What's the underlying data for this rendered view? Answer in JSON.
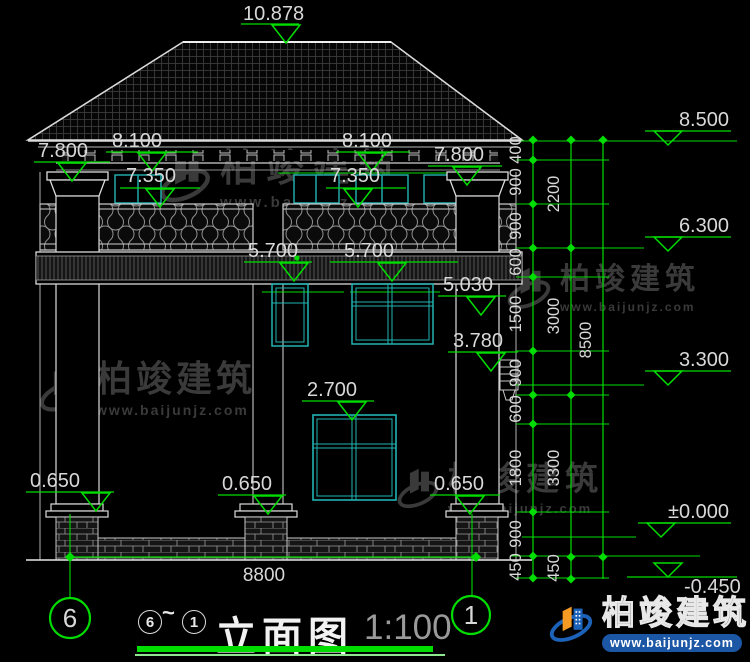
{
  "title_block": {
    "axis_left": "6",
    "axis_right": "1",
    "seq_start": "6",
    "seq_sep": "~",
    "seq_end": "1",
    "title": "立面图",
    "scale": "1:100"
  },
  "brand": {
    "name": "柏竣建筑",
    "url": "www.baijunjz.com"
  },
  "watermark": {
    "name": "柏竣建筑",
    "url": "www.baijunjz.com"
  },
  "colors": {
    "green": "#00dd00",
    "cyan": "#22b3b3",
    "dim_text": "#d8d8d8",
    "watermark": "#3a3a3a",
    "brand_blue": "#1b62b8",
    "brand_orange": "#f59a23"
  },
  "drawing": {
    "left_markers": [
      {
        "label": "10.878",
        "x1": 241,
        "x2": 299,
        "y": 24,
        "ax": 286,
        "tx": 243,
        "ty": 4
      },
      {
        "label": "8.100",
        "x1": 106,
        "x2": 198,
        "y": 152,
        "ax": 152,
        "tx": 112,
        "ty": 131
      },
      {
        "label": "8.100",
        "x1": 336,
        "x2": 410,
        "y": 152,
        "ax": 372,
        "tx": 342,
        "ty": 131
      },
      {
        "label": "7.800",
        "x1": 34,
        "x2": 110,
        "y": 162,
        "ax": 72,
        "tx": 38,
        "ty": 141
      },
      {
        "label": "7.800",
        "x1": 428,
        "x2": 502,
        "y": 166,
        "ax": 467,
        "tx": 434,
        "ty": 145
      },
      {
        "label": "7.350",
        "x1": 120,
        "x2": 200,
        "y": 188,
        "ax": 160,
        "tx": 126,
        "ty": 166
      },
      {
        "label": "7.350",
        "x1": 326,
        "x2": 406,
        "y": 188,
        "ax": 358,
        "tx": 330,
        "ty": 166
      },
      {
        "label": "5.700",
        "x1": 244,
        "x2": 312,
        "y": 262,
        "ax": 294,
        "tx": 248,
        "ty": 241
      },
      {
        "label": "5.700",
        "x1": 330,
        "x2": 458,
        "y": 262,
        "ax": 392,
        "tx": 344,
        "ty": 241
      },
      {
        "label": "5.030",
        "x1": 438,
        "x2": 506,
        "y": 296,
        "ax": 481,
        "tx": 443,
        "ty": 275
      },
      {
        "label": "3.780",
        "x1": 448,
        "x2": 518,
        "y": 352,
        "ax": 491,
        "tx": 453,
        "ty": 331
      },
      {
        "label": "2.700",
        "x1": 302,
        "x2": 374,
        "y": 401,
        "ax": 352,
        "tx": 307,
        "ty": 380
      },
      {
        "label": "0.650",
        "x1": 26,
        "x2": 114,
        "y": 492,
        "ax": 96,
        "tx": 30,
        "ty": 471
      },
      {
        "label": "0.650",
        "x1": 218,
        "x2": 286,
        "y": 495,
        "ax": 268,
        "tx": 222,
        "ty": 474
      },
      {
        "label": "0.650",
        "x1": 430,
        "x2": 500,
        "y": 495,
        "ax": 470,
        "tx": 434,
        "ty": 474
      }
    ],
    "right_levels": [
      {
        "label": "8.500",
        "y": 131,
        "x1": 645,
        "x2": 731,
        "ax": 668,
        "below": false
      },
      {
        "label": "6.300",
        "y": 237,
        "x1": 645,
        "x2": 731,
        "ax": 668,
        "below": false
      },
      {
        "label": "3.300",
        "y": 371,
        "x1": 645,
        "x2": 731,
        "ax": 668,
        "below": false
      },
      {
        "label": "±0.000",
        "y": 523,
        "x1": 638,
        "x2": 731,
        "ax": 661,
        "below": false
      },
      {
        "label": "-0.450",
        "y": 577,
        "x1": 627,
        "x2": 737,
        "ax": 668,
        "below": true
      }
    ],
    "chains": [
      {
        "x": 533,
        "y1": 140,
        "y2": 578,
        "lx": 521,
        "ticks": [
          140,
          160,
          204,
          248,
          277,
          351,
          395,
          424,
          512,
          556,
          578
        ],
        "labels": [
          {
            "t": "400",
            "y": 150
          },
          {
            "t": "900",
            "y": 182
          },
          {
            "t": "900",
            "y": 226
          },
          {
            "t": "600",
            "y": 262
          },
          {
            "t": "1500",
            "y": 314
          },
          {
            "t": "900",
            "y": 373
          },
          {
            "t": "600",
            "y": 409
          },
          {
            "t": "1800",
            "y": 468
          },
          {
            "t": "900",
            "y": 534
          },
          {
            "t": "450",
            "y": 567
          }
        ]
      },
      {
        "x": 571,
        "y1": 140,
        "y2": 579,
        "lx": 559,
        "ticks": [
          140,
          248,
          395,
          557,
          579
        ],
        "labels": [
          {
            "t": "2200",
            "y": 194
          },
          {
            "t": "3000",
            "y": 316
          },
          {
            "t": "3300",
            "y": 468
          },
          {
            "t": "450",
            "y": 568
          }
        ]
      },
      {
        "x": 603,
        "y1": 140,
        "y2": 579,
        "lx": 591,
        "ticks": [
          140,
          557
        ],
        "labels": [
          {
            "t": "8500",
            "y": 340
          }
        ]
      }
    ],
    "connectors": [
      {
        "y": 141,
        "x1": 520,
        "x2": 737
      },
      {
        "y": 160,
        "x1": 516,
        "x2": 609
      },
      {
        "y": 204,
        "x1": 516,
        "x2": 609
      },
      {
        "y": 248,
        "x1": 516,
        "x2": 644
      },
      {
        "y": 277,
        "x1": 516,
        "x2": 609
      },
      {
        "y": 351,
        "x1": 516,
        "x2": 609
      },
      {
        "y": 385,
        "x1": 510,
        "x2": 644
      },
      {
        "y": 395,
        "x1": 516,
        "x2": 609
      },
      {
        "y": 424,
        "x1": 516,
        "x2": 609
      },
      {
        "y": 512,
        "x1": 516,
        "x2": 609
      },
      {
        "y": 537,
        "x1": 522,
        "x2": 636
      },
      {
        "y": 556,
        "x1": 510,
        "x2": 700
      },
      {
        "y": 578,
        "x1": 516,
        "x2": 609
      }
    ],
    "bottom_dim": {
      "label": "8800",
      "y": 557,
      "x1": 70,
      "x2": 476,
      "tx": 264,
      "ty": 581
    },
    "extensions": [
      {
        "x": 70,
        "y1": 514,
        "y2": 597
      },
      {
        "x": 472,
        "y1": 514,
        "y2": 595
      }
    ],
    "bubbles": [
      {
        "label": "6",
        "cx": 70,
        "cy": 618,
        "r": 20
      },
      {
        "label": "1",
        "cx": 471,
        "cy": 615,
        "r": 19
      }
    ],
    "green_dot": {
      "cx": 297,
      "cy": 258
    }
  }
}
